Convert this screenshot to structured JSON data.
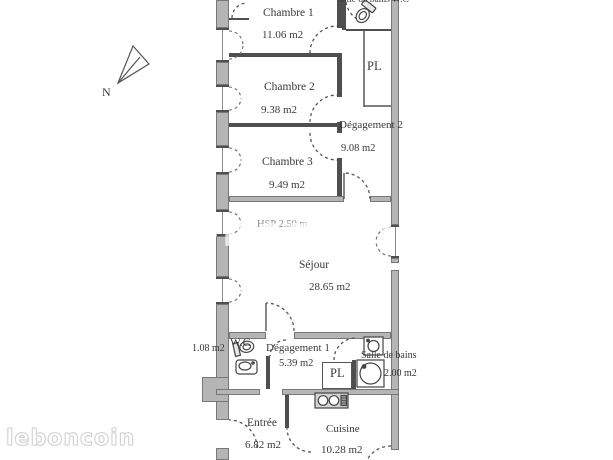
{
  "branding": {
    "watermark": "leboncoin",
    "watermark_faint": "leboncoin"
  },
  "compass": {
    "label": "N"
  },
  "rooms": {
    "sdb_wc_top": {
      "name": "Salle de bains W.C"
    },
    "chambre1": {
      "name": "Chambre 1",
      "area": "11.06 m2"
    },
    "pl_top": {
      "name": "PL"
    },
    "chambre2": {
      "name": "Chambre 2",
      "area": "9.38 m2"
    },
    "degagement2": {
      "name": "Dégagement 2",
      "area": "9.08 m2"
    },
    "chambre3": {
      "name": "Chambre 3",
      "area": "9.49 m2"
    },
    "sejour": {
      "name": "Séjour",
      "area": "28.65 m2",
      "ceiling": "HSP 2.50 m"
    },
    "wc": {
      "name": "W.C",
      "area": "1.08 m2"
    },
    "degagement1": {
      "name": "Dégagement 1",
      "area": "5.39 m2"
    },
    "pl_bottom": {
      "name": "PL"
    },
    "salle_de_bains": {
      "name": "Salle de bains",
      "area": "2.00 m2"
    },
    "entree": {
      "name": "Entrée",
      "area": "6.82 m2"
    },
    "cuisine": {
      "name": "Cuisine",
      "area": "10.28 m2"
    }
  },
  "colors": {
    "wall": "#b5b5b5",
    "wall_edge": "#787878",
    "line": "#4f4f4f",
    "text": "#3a3a3a"
  }
}
